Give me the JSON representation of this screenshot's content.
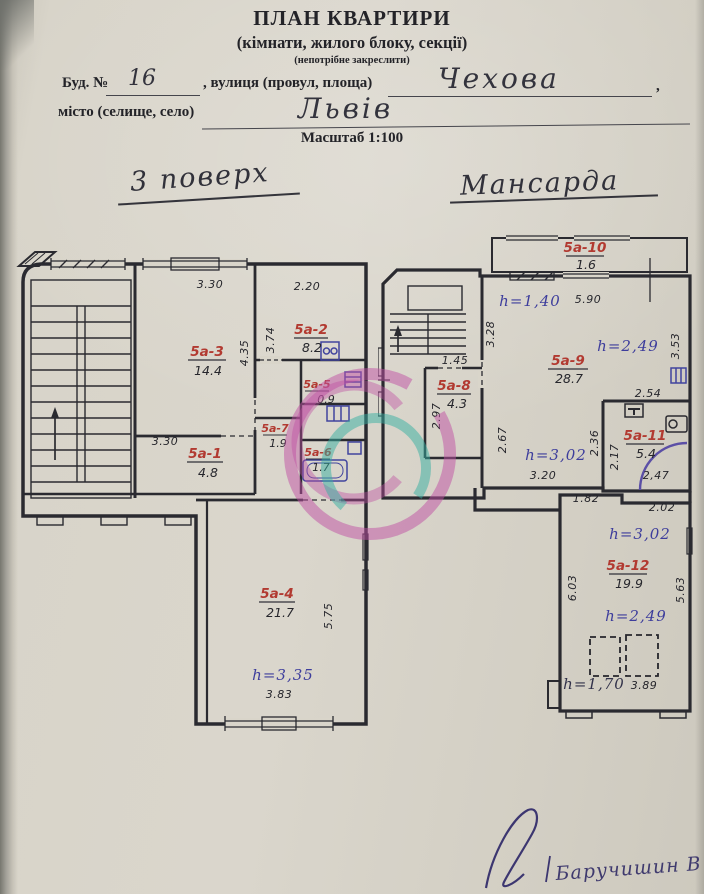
{
  "header": {
    "title": "ПЛАН КВАРТИРИ",
    "subtitle": "(кімнати, жилого блоку, секції)",
    "note": "(непотрібне закреслити)",
    "building_label": "Буд. №",
    "building_number": "16",
    "street_label": ", вулиця (провул, площа)",
    "street_value": "Чехова",
    "comma": ",",
    "city_label": "місто (селище, село)",
    "city_value": "Львів",
    "scale": "Масштаб 1:100"
  },
  "plan_left": {
    "title": "3 поверх",
    "rooms": [
      {
        "id": "5а-3",
        "area": "14.4"
      },
      {
        "id": "5а-2",
        "area": "8.2"
      },
      {
        "id": "5а-5",
        "area": "0.9"
      },
      {
        "id": "5а-7",
        "area": "1.9"
      },
      {
        "id": "5а-6",
        "area": "1.7"
      },
      {
        "id": "5а-1",
        "area": "4.8"
      },
      {
        "id": "5а-4",
        "area": "21.7"
      }
    ],
    "dims": [
      "3.30",
      "2.20",
      "4.35",
      "3.74",
      "3.30",
      "5.75",
      "3.83"
    ],
    "heights": [
      "h=3,35"
    ]
  },
  "plan_right": {
    "title": "Мансарда",
    "rooms": [
      {
        "id": "5а-10",
        "area": "1.6"
      },
      {
        "id": "5а-9",
        "area": "28.7"
      },
      {
        "id": "5а-8",
        "area": "4.3"
      },
      {
        "id": "5а-11",
        "area": "5.4"
      },
      {
        "id": "5а-12",
        "area": "19.9"
      }
    ],
    "dims": [
      "5.90",
      "3.28",
      "1.45",
      "2.97",
      "2.67",
      "3.53",
      "2.54",
      "2.36",
      "2.17",
      "2,47",
      "3.20",
      "1.82",
      "2.02",
      "6.03",
      "5.63",
      "3.89"
    ],
    "heights": [
      "h=1,40",
      "h=2,49",
      "h=3,02",
      "h=3,02",
      "h=2,49",
      "h=1,70"
    ]
  },
  "footer": {
    "signature_name": "Баручишин В"
  },
  "colors": {
    "wall": "#2a2a30",
    "red_label": "#b23a31",
    "ink_blue": "#3d3d9c",
    "fixture_blue": "#41449e",
    "watermark_pink": "#bf4fa3",
    "watermark_teal": "#35b0a2"
  }
}
